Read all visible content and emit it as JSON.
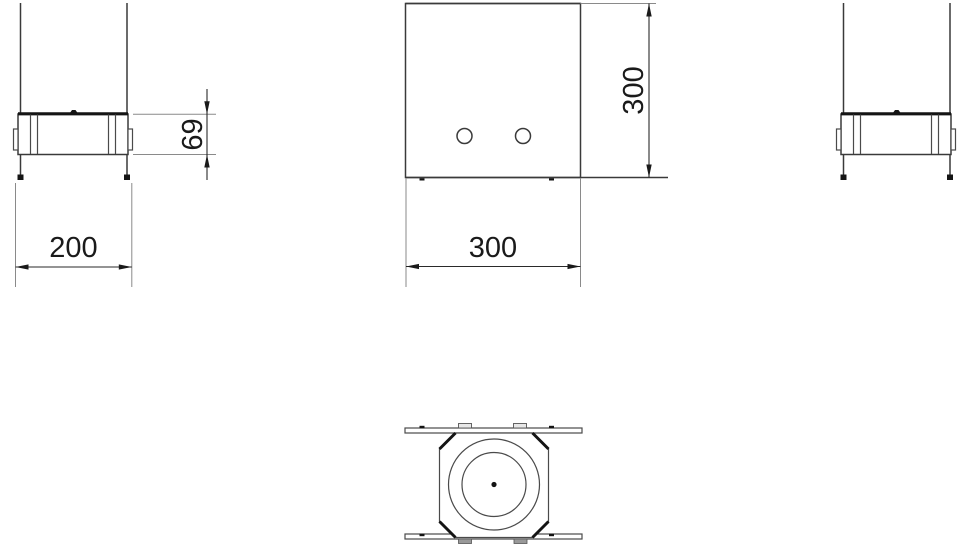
{
  "drawing": {
    "dimensions": {
      "side_width": "200",
      "side_height": "69",
      "front_width": "300",
      "front_height": "300"
    },
    "colors": {
      "background": "#ffffff",
      "line": "#3a3a3a",
      "thick_line": "#141414",
      "extension_line": "#8a8a8a",
      "dimension_text": "#1a1a1a",
      "tab_fill_grey": "#999999",
      "tab_fill_light": "#e8e8e8"
    }
  }
}
